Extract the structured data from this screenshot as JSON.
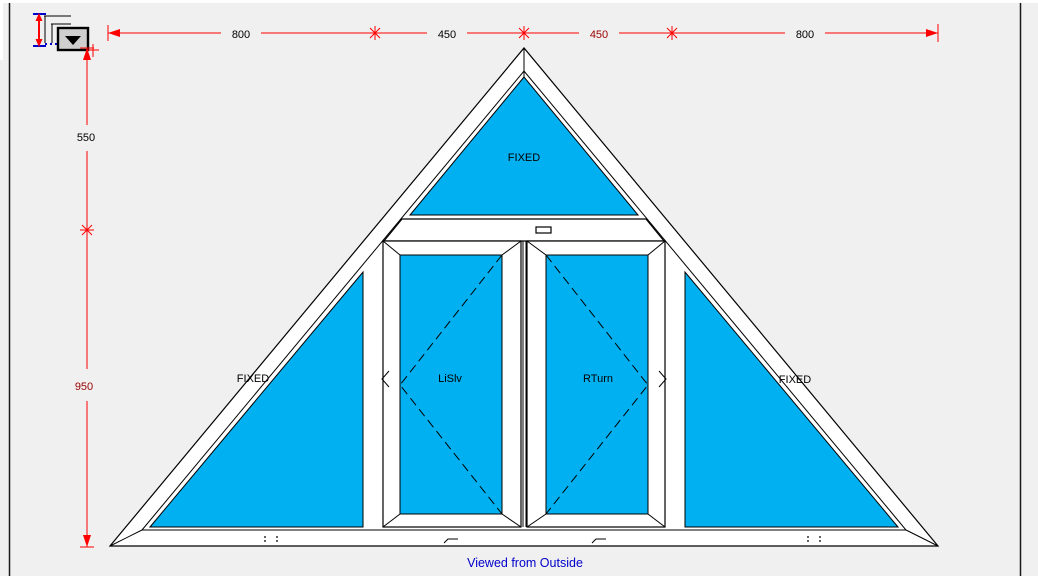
{
  "app": {
    "description": "Window design CAD canvas, triangular frame drawing viewed from outside"
  },
  "icons": {
    "dimension_tool": "dimension-measure-icon",
    "dropdown": "chevron-down-icon",
    "crosshair": "crosshair-icon"
  },
  "dimensions": {
    "top": {
      "labels": [
        {
          "text": "800",
          "color": "#000000"
        },
        {
          "text": "450",
          "color": "#000000"
        },
        {
          "text": "450",
          "color": "#990000"
        },
        {
          "text": "800",
          "color": "#000000"
        }
      ]
    },
    "left": {
      "labels": [
        {
          "text": "550",
          "color": "#000000"
        },
        {
          "text": "950",
          "color": "#990000"
        }
      ]
    }
  },
  "drawing": {
    "panes": {
      "apex": "FIXED",
      "left": "FIXED",
      "right": "FIXED",
      "sash_left": "LiSlv",
      "sash_right": "RTurn"
    },
    "glass_color": "#00B0F0"
  },
  "footer": {
    "note": "Viewed from Outside",
    "color": "#0000CC"
  },
  "colors": {
    "dimension": "#FF0000",
    "dimension_alt": "#990000",
    "frame_outline": "#000000",
    "canvas_bg": "#F0F0F0"
  }
}
